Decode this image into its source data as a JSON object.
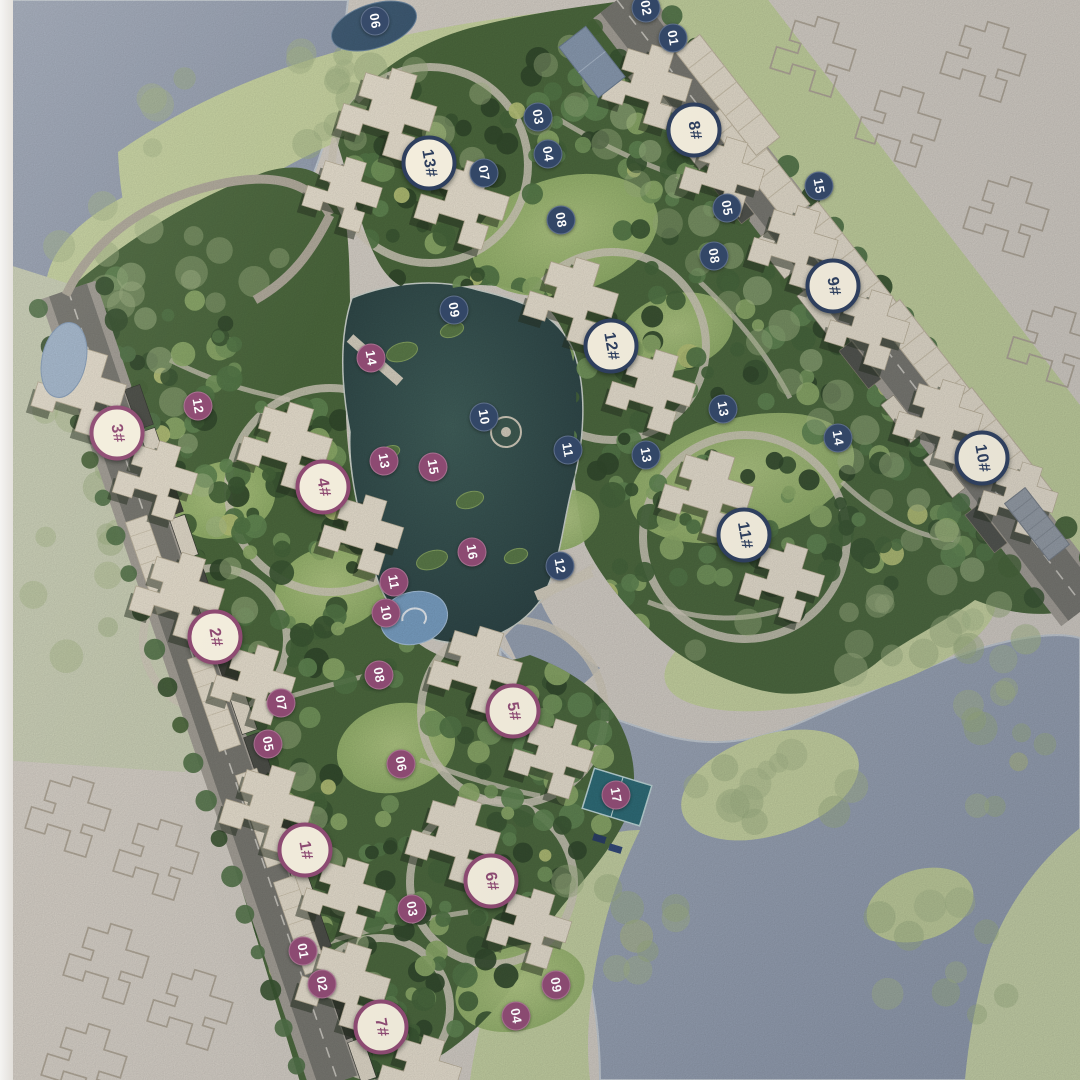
{
  "map": {
    "colors": {
      "west_accent": "#8e4a72",
      "east_accent": "#2e3f5e",
      "label_fill": "#f3eddc",
      "river": "#9aa5b6",
      "lake": "#35504e",
      "meadow": "#ccd8a4",
      "dense_canopy": "#3c5833",
      "paper": "#d9d3ca"
    },
    "building_labels": [
      {
        "label": "1#",
        "zone": "west",
        "x": 305,
        "y": 850
      },
      {
        "label": "2#",
        "zone": "west",
        "x": 215,
        "y": 637
      },
      {
        "label": "3#",
        "zone": "west",
        "x": 117,
        "y": 433
      },
      {
        "label": "4#",
        "zone": "west",
        "x": 323,
        "y": 487
      },
      {
        "label": "5#",
        "zone": "west",
        "x": 513,
        "y": 711
      },
      {
        "label": "6#",
        "zone": "west",
        "x": 491,
        "y": 881
      },
      {
        "label": "7#",
        "zone": "west",
        "x": 381,
        "y": 1027
      },
      {
        "label": "8#",
        "zone": "east",
        "x": 694,
        "y": 130
      },
      {
        "label": "9#",
        "zone": "east",
        "x": 833,
        "y": 286
      },
      {
        "label": "10#",
        "zone": "east",
        "x": 982,
        "y": 458
      },
      {
        "label": "11#",
        "zone": "east",
        "x": 744,
        "y": 535
      },
      {
        "label": "12#",
        "zone": "east",
        "x": 611,
        "y": 346
      },
      {
        "label": "13#",
        "zone": "east",
        "x": 429,
        "y": 163
      }
    ],
    "site_markers": [
      {
        "label": "01",
        "zone": "west",
        "x": 303,
        "y": 951
      },
      {
        "label": "02",
        "zone": "west",
        "x": 322,
        "y": 984
      },
      {
        "label": "03",
        "zone": "west",
        "x": 412,
        "y": 909
      },
      {
        "label": "04",
        "zone": "west",
        "x": 516,
        "y": 1016
      },
      {
        "label": "05",
        "zone": "west",
        "x": 268,
        "y": 744
      },
      {
        "label": "06",
        "zone": "west",
        "x": 401,
        "y": 764
      },
      {
        "label": "07",
        "zone": "west",
        "x": 281,
        "y": 703
      },
      {
        "label": "08",
        "zone": "west",
        "x": 379,
        "y": 675
      },
      {
        "label": "09",
        "zone": "west",
        "x": 556,
        "y": 985
      },
      {
        "label": "10",
        "zone": "west",
        "x": 386,
        "y": 613
      },
      {
        "label": "11",
        "zone": "west",
        "x": 394,
        "y": 582
      },
      {
        "label": "12",
        "zone": "west",
        "x": 198,
        "y": 406
      },
      {
        "label": "13",
        "zone": "west",
        "x": 384,
        "y": 461
      },
      {
        "label": "14",
        "zone": "west",
        "x": 371,
        "y": 358
      },
      {
        "label": "15",
        "zone": "west",
        "x": 433,
        "y": 467
      },
      {
        "label": "16",
        "zone": "west",
        "x": 472,
        "y": 552
      },
      {
        "label": "17",
        "zone": "west",
        "x": 616,
        "y": 795
      },
      {
        "label": "01",
        "zone": "east",
        "x": 673,
        "y": 38
      },
      {
        "label": "02",
        "zone": "east",
        "x": 646,
        "y": 8
      },
      {
        "label": "03",
        "zone": "east",
        "x": 538,
        "y": 117
      },
      {
        "label": "04",
        "zone": "east",
        "x": 548,
        "y": 154
      },
      {
        "label": "05",
        "zone": "east",
        "x": 727,
        "y": 208
      },
      {
        "label": "06",
        "zone": "east",
        "x": 375,
        "y": 21
      },
      {
        "label": "07",
        "zone": "east",
        "x": 484,
        "y": 173
      },
      {
        "label": "08",
        "zone": "east",
        "x": 561,
        "y": 220
      },
      {
        "label": "08",
        "zone": "east",
        "x": 714,
        "y": 256
      },
      {
        "label": "09",
        "zone": "east",
        "x": 454,
        "y": 310
      },
      {
        "label": "10",
        "zone": "east",
        "x": 484,
        "y": 417
      },
      {
        "label": "11",
        "zone": "east",
        "x": 568,
        "y": 450
      },
      {
        "label": "12",
        "zone": "east",
        "x": 560,
        "y": 566
      },
      {
        "label": "13",
        "zone": "east",
        "x": 723,
        "y": 409
      },
      {
        "label": "13",
        "zone": "east",
        "x": 646,
        "y": 455
      },
      {
        "label": "14",
        "zone": "east",
        "x": 838,
        "y": 438
      },
      {
        "label": "15",
        "zone": "east",
        "x": 819,
        "y": 186
      }
    ]
  }
}
